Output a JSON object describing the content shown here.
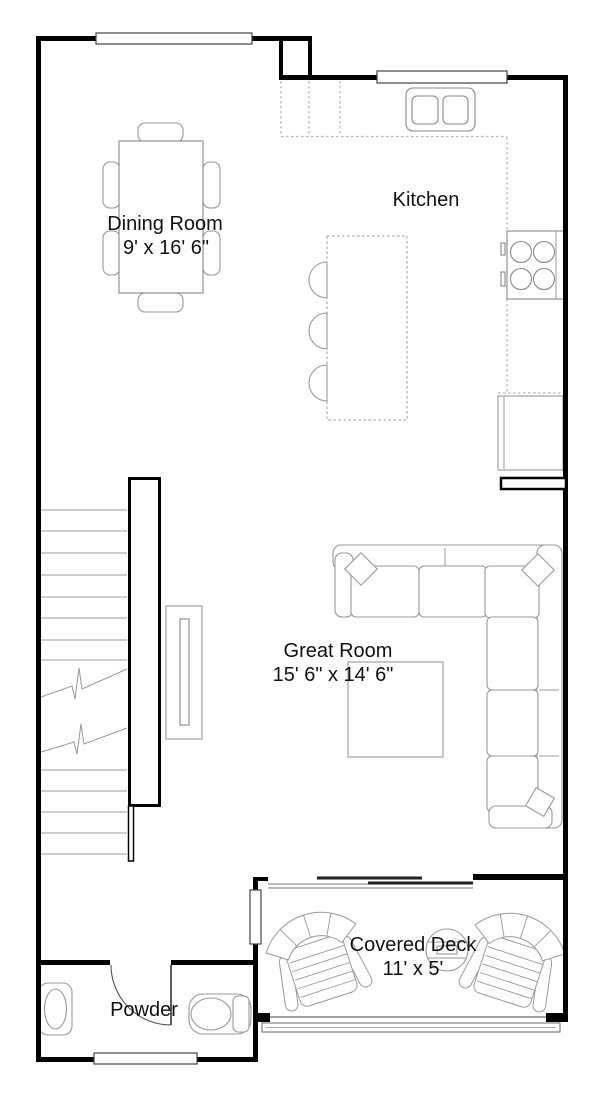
{
  "plan": {
    "title": "First floor plan",
    "rooms": {
      "dining": {
        "label": "Dining Room",
        "dims": "9' x 16' 6\""
      },
      "kitchen": {
        "label": "Kitchen"
      },
      "great": {
        "label": "Great Room",
        "dims": "15' 6\" x 14' 6\""
      },
      "deck": {
        "label": "Covered Deck",
        "dims": "11' x 5'"
      },
      "powder": {
        "label": "Powder"
      }
    },
    "colors": {
      "wall": "#000000",
      "furniture_outline": "#999999",
      "counter_outline": "#b5b5b5",
      "text": "#111111",
      "background": "#ffffff"
    }
  }
}
